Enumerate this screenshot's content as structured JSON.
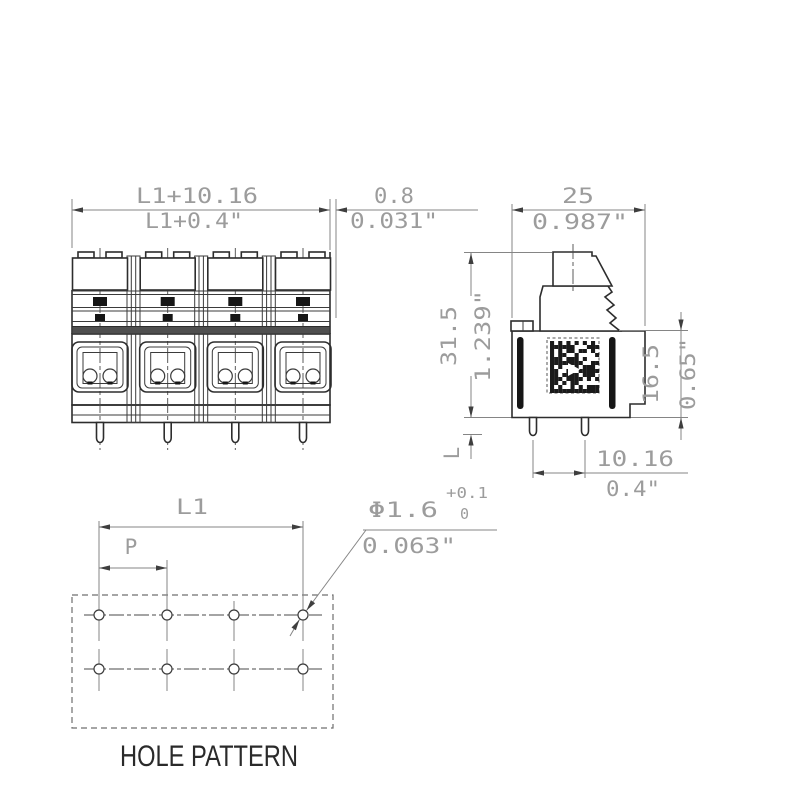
{
  "front_view": {
    "overall_width_mm": "L1+10.16",
    "overall_width_in": "L1+0.4\"",
    "edge_offset_mm": "0.8",
    "edge_offset_in": "0.031\""
  },
  "side_view": {
    "depth_mm": "25",
    "depth_in": "0.987\"",
    "overall_height_mm": "31.5",
    "overall_height_in": "1.239\"",
    "body_height_mm": "16.5",
    "body_height_in": "0.65\"",
    "pin_spacing_mm": "10.16",
    "pin_spacing_in": "0.4\"",
    "pin_length_label": "L"
  },
  "hole_pattern": {
    "title": "HOLE PATTERN",
    "span_label": "L1",
    "pitch_label": "P",
    "hole_diameter_mm": "Φ1.6",
    "tolerance_upper": "+0.1",
    "tolerance_lower": "0",
    "hole_diameter_in": "0.063\""
  }
}
